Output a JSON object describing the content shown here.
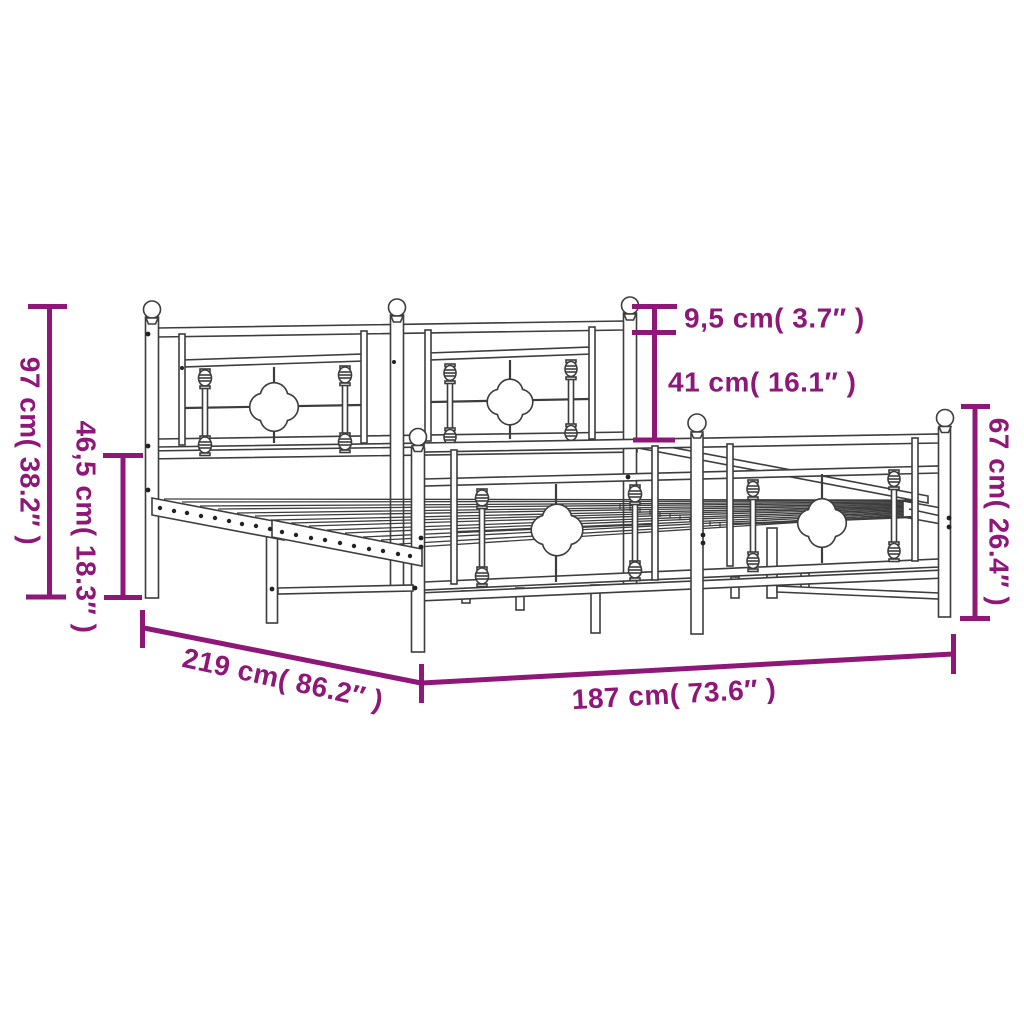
{
  "diagram": {
    "title": "bed-frame-dimension-diagram",
    "background": "#ffffff",
    "accent_color": "#8e1778",
    "line_color": "#3d3d3d",
    "dimensions": {
      "headboard_height": {
        "label": "97 cm( 38.2″ )",
        "cm": "97",
        "inches": "38.2"
      },
      "base_height": {
        "label": "46,5 cm( 18.3″ )",
        "cm": "46,5",
        "inches": "18.3"
      },
      "finial_gap": {
        "label": "9,5 cm( 3.7″ )",
        "cm": "9,5",
        "inches": "3.7"
      },
      "panel_height": {
        "label": "41 cm( 16.1″ )",
        "cm": "41",
        "inches": "16.1"
      },
      "footboard_height": {
        "label": "67 cm( 26.4″ )",
        "cm": "67",
        "inches": "26.4"
      },
      "total_length": {
        "label": "219 cm( 86.2″ )",
        "cm": "219",
        "inches": "86.2"
      },
      "total_width": {
        "label": "187 cm( 73.6″ )",
        "cm": "187",
        "inches": "73.6"
      }
    }
  }
}
